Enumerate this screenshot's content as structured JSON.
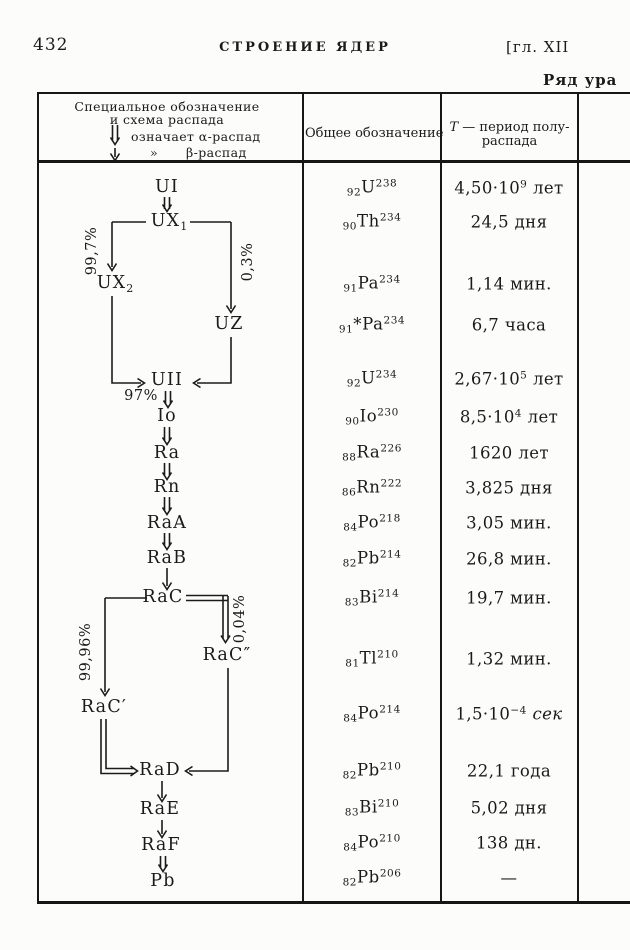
{
  "page": {
    "number": "432",
    "running_title": "СТРОЕНИЕ ЯДЕР",
    "chapter": "[гл. XII",
    "series_title": "Ряд ура"
  },
  "table": {
    "col1_header": {
      "line1": "Специальное обозначение",
      "line2": "и схема распада",
      "alpha_legend": "означает α-распад",
      "ditto_mark": "»",
      "beta_legend": "β-распад"
    },
    "col2_header": "Общее обозначение",
    "col3_header": {
      "t": "T",
      "rest": " — период полу-",
      "line2": "распада"
    }
  },
  "chain": {
    "nodes": [
      {
        "label": "UI"
      },
      {
        "label": "UX",
        "sub": "1"
      },
      {
        "label": "UX",
        "sub": "2"
      },
      {
        "label": "UZ"
      },
      {
        "label": "UII"
      },
      {
        "label": "Io"
      },
      {
        "label": "Ra"
      },
      {
        "label": "Rn"
      },
      {
        "label": "RaA"
      },
      {
        "label": "RaB"
      },
      {
        "label": "RaC"
      },
      {
        "label": "RaC″"
      },
      {
        "label": "RaC′"
      },
      {
        "label": "RaD"
      },
      {
        "label": "RaE"
      },
      {
        "label": "RaF"
      },
      {
        "label": "Pb"
      }
    ],
    "percents": {
      "p997": "99,7%",
      "p03": "0,3%",
      "p97": "97%",
      "p9996": "99,96%",
      "p004": "0,04%"
    }
  },
  "rows": [
    {
      "isotope": {
        "sub": "92",
        "el": "U",
        "sup": "238"
      },
      "halflife": {
        "pre": "4,50·10",
        "sup": "9",
        "post": " лет"
      }
    },
    {
      "isotope": {
        "sub": "90",
        "el": "Th",
        "sup": "234"
      },
      "halflife": {
        "pre": "24,5 дня"
      }
    },
    {
      "isotope": {
        "sub": "91",
        "el": "Pa",
        "sup": "234"
      },
      "halflife": {
        "pre": "1,14 мин."
      }
    },
    {
      "isotope": {
        "sub": "91",
        "el": "*Pa",
        "sup": "234"
      },
      "halflife": {
        "pre": "6,7 часа"
      }
    },
    {
      "isotope": {
        "sub": "92",
        "el": "U",
        "sup": "234"
      },
      "halflife": {
        "pre": "2,67·10",
        "sup": "5",
        "post": " лет"
      }
    },
    {
      "isotope": {
        "sub": "90",
        "el": "Io",
        "sup": "230"
      },
      "halflife": {
        "pre": "8,5·10",
        "sup": "4",
        "post": " лет"
      }
    },
    {
      "isotope": {
        "sub": "88",
        "el": "Ra",
        "sup": "226"
      },
      "halflife": {
        "pre": "1620 лет"
      }
    },
    {
      "isotope": {
        "sub": "86",
        "el": "Rn",
        "sup": "222"
      },
      "halflife": {
        "pre": "3,825 дня"
      }
    },
    {
      "isotope": {
        "sub": "84",
        "el": "Po",
        "sup": "218"
      },
      "halflife": {
        "pre": "3,05 мин."
      }
    },
    {
      "isotope": {
        "sub": "82",
        "el": "Pb",
        "sup": "214"
      },
      "halflife": {
        "pre": "26,8 мин."
      }
    },
    {
      "isotope": {
        "sub": "83",
        "el": "Bi",
        "sup": "214"
      },
      "halflife": {
        "pre": "19,7 мин."
      }
    },
    {
      "isotope": {
        "sub": "81",
        "el": "Tl",
        "sup": "210"
      },
      "halflife": {
        "pre": "1,32 мин."
      }
    },
    {
      "isotope": {
        "sub": "84",
        "el": "Po",
        "sup": "214"
      },
      "halflife": {
        "pre": "1,5·10",
        "sup": "−4",
        "post_italic": " сек"
      }
    },
    {
      "isotope": {
        "sub": "82",
        "el": "Pb",
        "sup": "210"
      },
      "halflife": {
        "pre": "22,1 года"
      }
    },
    {
      "isotope": {
        "sub": "83",
        "el": "Bi",
        "sup": "210"
      },
      "halflife": {
        "pre": "5,02 дня"
      }
    },
    {
      "isotope": {
        "sub": "84",
        "el": "Po",
        "sup": "210"
      },
      "halflife": {
        "pre": "138 дн."
      }
    },
    {
      "isotope": {
        "sub": "82",
        "el": "Pb",
        "sup": "206"
      },
      "halflife": {
        "pre": "—"
      }
    }
  ]
}
